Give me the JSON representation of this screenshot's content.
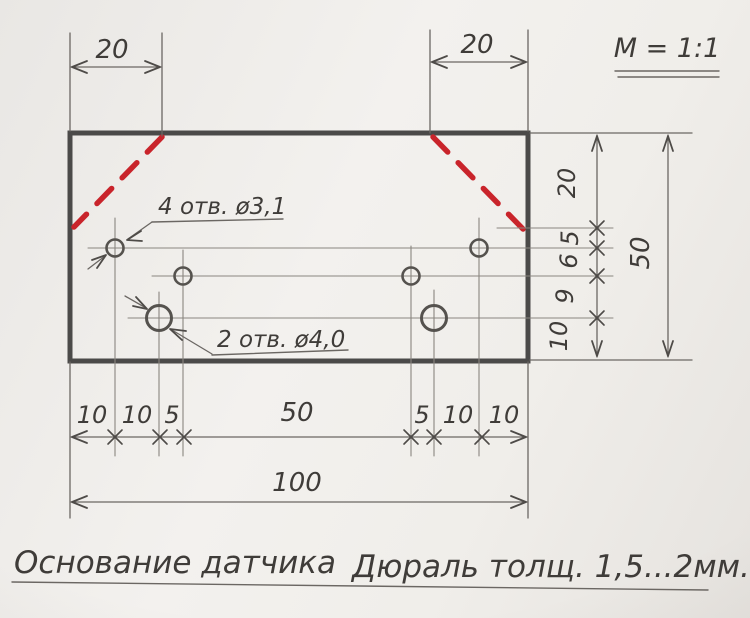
{
  "meta": {
    "scale_label": "M = 1:1"
  },
  "captions": {
    "title": "Основание датчика",
    "material": "Дюраль толщ. 1,5...2мм."
  },
  "callouts": {
    "small_holes": "4 отв. ø3,1",
    "large_holes": "2 отв. ø4,0"
  },
  "dimensions": {
    "top_left": "20",
    "top_right": "20",
    "right_chain": [
      "20",
      "5",
      "6",
      "9",
      "10"
    ],
    "right_total": "50",
    "bottom_chain": [
      "10",
      "10",
      "5",
      "50",
      "5",
      "10",
      "10"
    ],
    "bottom_total": "100"
  },
  "colors": {
    "paper": "#efede9",
    "pencil": "#8a8680",
    "pencil_dark": "#6b6763",
    "arrow": "#4e4b48",
    "ink": "#3f3c39",
    "plate": "#4b4a49",
    "red": "#c9242b"
  }
}
